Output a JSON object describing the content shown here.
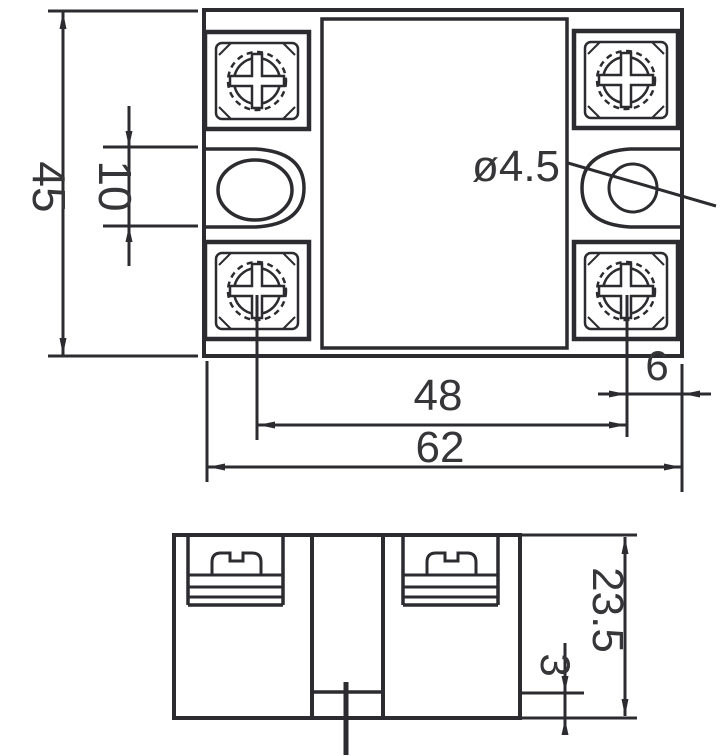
{
  "top_view": {
    "dim_overall_height": "45",
    "dim_mount_slot_length": "10",
    "dim_mount_hole_diameter": "ø4.5",
    "dim_mount_hole_spacing": "48",
    "dim_overall_width": "62",
    "dim_hole_to_edge": "6"
  },
  "side_view": {
    "dim_body_height": "23.5",
    "dim_base_step": "3"
  },
  "colors": {
    "line": "#2c2c30",
    "text": "#363639",
    "background": "#ffffff"
  }
}
